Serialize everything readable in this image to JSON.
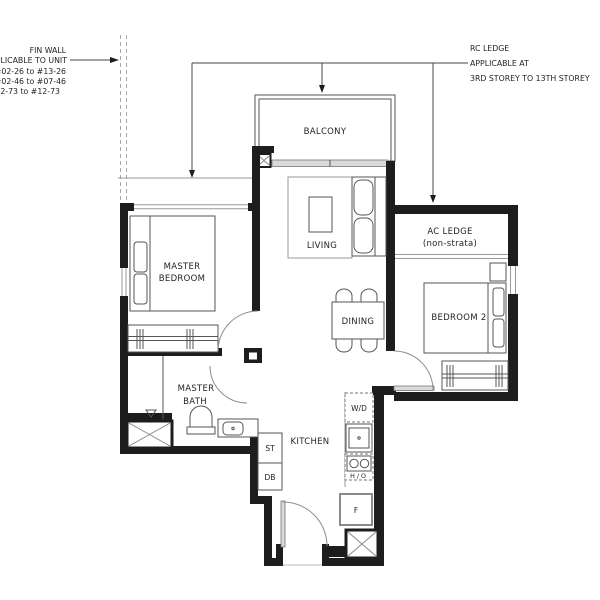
{
  "notes": {
    "fin_wall": [
      "FIN WALL",
      "APPLICABLE TO UNIT",
      "#02-26 to #13-26",
      "#02-46 to #07-46",
      "#02-73  to #12-73"
    ],
    "rc_ledge": [
      "RC LEDGE",
      "APPLICABLE AT",
      "3RD STOREY TO 13TH STOREY"
    ]
  },
  "rooms": {
    "balcony": "BALCONY",
    "living": "LIVING",
    "master_bedroom": [
      "MASTER",
      "BEDROOM"
    ],
    "ac_ledge": [
      "AC LEDGE",
      "(non-strata)"
    ],
    "bedroom2": "BEDROOM 2",
    "dining": "DINING",
    "master_bath": [
      "MASTER",
      "BATH"
    ],
    "kitchen": "KITCHEN"
  },
  "fixtures": {
    "washer_dryer": "W/D",
    "hob_oven": "H / O",
    "fridge": "F",
    "store": "ST",
    "distribution_board": "DB"
  },
  "colors": {
    "wall": "#1d1d1d",
    "thin_line": "#555555",
    "light_line": "#9a9a9a",
    "door_fill": "#d9d9d9",
    "background": "#ffffff"
  }
}
